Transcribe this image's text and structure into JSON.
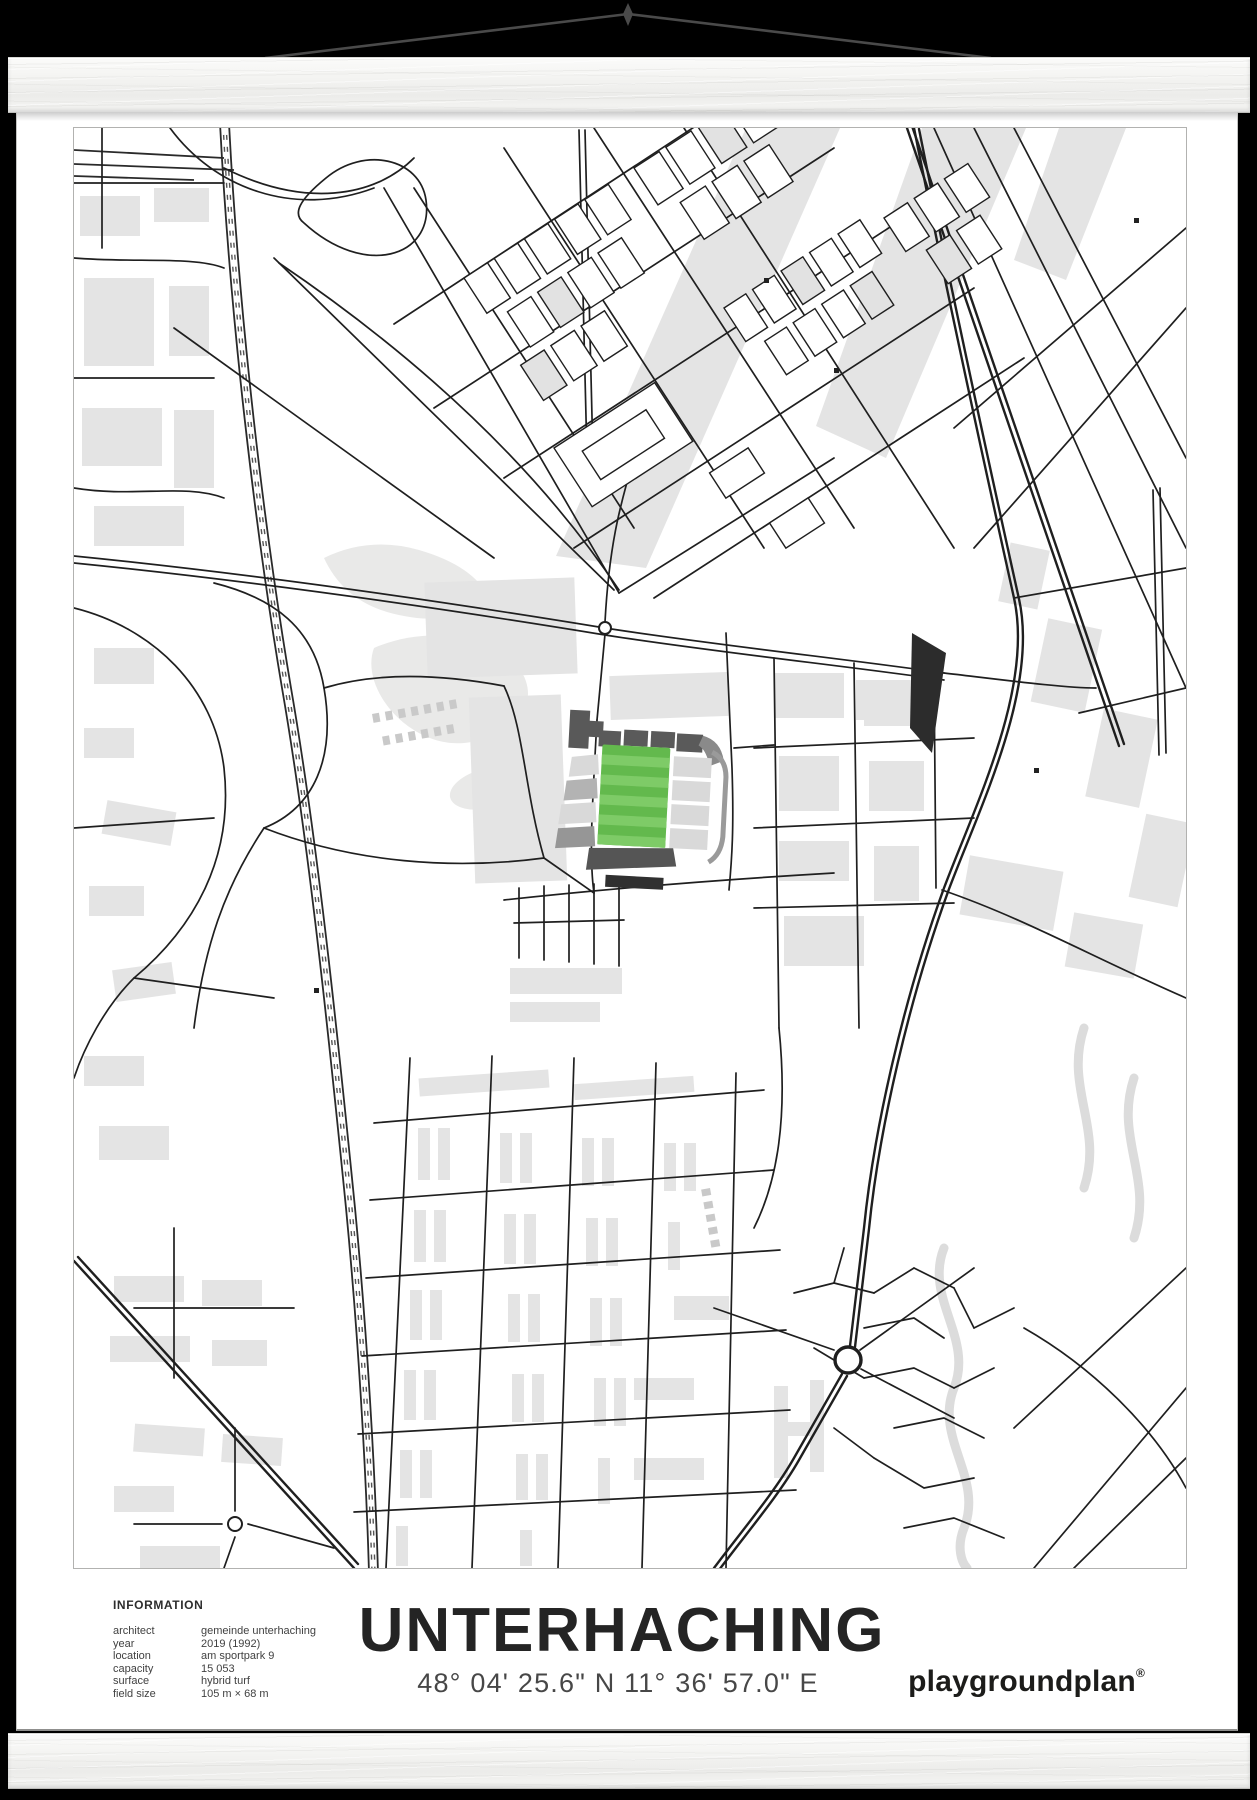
{
  "poster": {
    "info": {
      "heading": "INFORMATION",
      "rows": [
        {
          "label": "architect",
          "value": "gemeinde unterhaching"
        },
        {
          "label": "year",
          "value": "2019 (1992)"
        },
        {
          "label": "location",
          "value": "am sportpark 9"
        },
        {
          "label": "capacity",
          "value": "15 053"
        },
        {
          "label": "surface",
          "value": "hybrid turf"
        },
        {
          "label": "field size",
          "value": "105 m × 68 m"
        }
      ]
    },
    "title": "UNTERHACHING",
    "coordinates": "48° 04' 25.6\" N 11° 36' 57.0\" E",
    "brand": "playgroundplan",
    "brand_registered": "®"
  },
  "map": {
    "subject": "stadium city map with highlighted football pitch"
  },
  "colors": {
    "background": "#000000",
    "poster": "#ffffff",
    "street": "#1f1f1f",
    "building": "#e4e4e4",
    "pitch_green": "#63b94d",
    "pitch_stripe": "#7ecb67",
    "stand_dark": "#565656",
    "stand_mid": "#9a9a9a",
    "stand_light": "#d9d9d9",
    "wood": "#f4f4f2",
    "cord": "#4a4a4a"
  }
}
